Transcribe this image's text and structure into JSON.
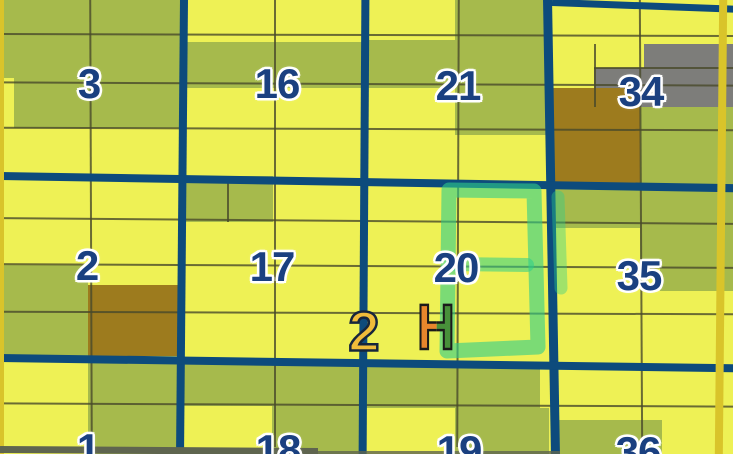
{
  "map": {
    "type": "cadastral-plat-map",
    "sections": [
      {
        "label": "3"
      },
      {
        "label": "16"
      },
      {
        "label": "21"
      },
      {
        "label": "34"
      },
      {
        "label": "2"
      },
      {
        "label": "17"
      },
      {
        "label": "20"
      },
      {
        "label": "35"
      },
      {
        "label": "1"
      },
      {
        "label": "18"
      },
      {
        "label": "19"
      },
      {
        "label": "36"
      }
    ],
    "markers": {
      "route_label": "2",
      "h_label": "H"
    },
    "highlight": {
      "shape": "rectangle-with-middle-bar",
      "color": "#2ecd8a",
      "around_section": "20"
    },
    "colors": {
      "base_parcel": "#eef155",
      "olive_parcel": "#a6ba4c",
      "brown_parcel": "#9d7b1e",
      "gray_parcel": "#7d7d7a",
      "section_line": "#0d4b7c",
      "boundary_line_gold": "#d9c42a",
      "section_label": "#1a4080",
      "route_marker_fill": "#f0bc3a",
      "h_marker_orange": "#e8862c",
      "h_marker_green": "#48903a"
    }
  }
}
